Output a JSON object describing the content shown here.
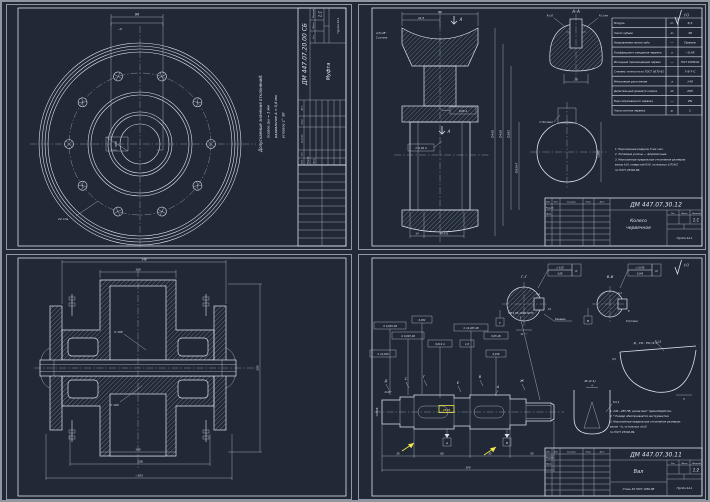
{
  "colors": {
    "background": "#212836",
    "line": "#dde3ea",
    "accent_highlight": "#f4e84c"
  },
  "tb": {
    "r1": "Изм.",
    "r2": "Лист",
    "r3": "№ докум.",
    "r4": "Подп.",
    "r5": "Дата",
    "p1": "Разраб.",
    "p2": "Пров.",
    "p3": "Н.контр.",
    "p4": "Утв.",
    "lit": "Лит.",
    "mass": "Масса",
    "scale_lbl": "Масштаб",
    "org": "Группа 4А-1"
  },
  "sheet1": {
    "title": {
      "doc": "ДМ 447.07.20.00 СБ",
      "name": "Муфта",
      "scale": "1:1"
    },
    "note_title": "Допускаемые значения отклонений:",
    "note_axial": "осевое  Δω = 1 мм",
    "note_radial": "радиальное  Δ ≈ 0,6 мм",
    "note_angular": "угловое  1° 30′",
    "dim_width": "90",
    "dim_key": "~6",
    "dim_holes": "12 отв.",
    "dim_bore": "50H7"
  },
  "sheet2": {
    "roughness": "(√)",
    "section_label": "А–А",
    "sec_r1": "R≈10",
    "sec_r2": "R≈1 мм",
    "sec_w": "28",
    "arrow": "А",
    "dim_top": "90",
    "dim_left": "42,5",
    "chamfer": "4,5×45°",
    "chamfer2": "2 уступа",
    "d1": "∅450",
    "d2": "∅420",
    "d3": "∅265",
    "d4": "∅85H7",
    "b1": "14",
    "b2": "40 h11",
    "tol1": "0,05  А",
    "tol2": "∅ 0,02  А",
    "key_dim": "∅ 64 макс",
    "circle_d": "∅265",
    "table": [
      {
        "name": "Модуль",
        "sym": "m",
        "val": "6,3"
      },
      {
        "name": "Число зубьев",
        "sym": "z₂",
        "val": "48"
      },
      {
        "name": "Направление линии зуба",
        "sym": "—",
        "val": "Правое"
      },
      {
        "name": "Коэффициент смещения червяка",
        "sym": "x",
        "val": "−0,45"
      },
      {
        "name": "Исходный производящий червяк",
        "sym": "—",
        "val": "ГОСТ 19036-94"
      },
      {
        "name": "Степень точности по ГОСТ 3675-81",
        "sym": "",
        "val": "7-8-7-С"
      },
      {
        "name": "Межосевое расстояние",
        "sym": "a",
        "val": "140"
      },
      {
        "name": "Делительный диаметр колеса",
        "sym": "d₂",
        "val": "265"
      },
      {
        "name": "Вид сопряжённого червяка",
        "sym": "—",
        "val": "ZN"
      },
      {
        "name": "Число витков червяка",
        "sym": "z₁",
        "val": "1"
      }
    ],
    "notes": [
      "1. Неуказанные радиусы 5 мм max.",
      "2. Литейные уклоны — формовочные.",
      "3. Неуказанные предельные отклонения размеров:",
      "    валов h14, отверстий H14, остальных ±IT14/2",
      "    по ГОСТ 25346-89."
    ],
    "title": {
      "doc": "ДМ 447.07.30.12",
      "name1": "Колесо",
      "name2": "червячное",
      "scale": "1:1"
    }
  },
  "sheet3": {
    "t1": "148",
    "t2": "100",
    "bore1": "∅ 100",
    "bore2": "∅ 100",
    "b1": "145",
    "b2": "158",
    "b3": "~203",
    "r1": "205"
  },
  "sheet4": {
    "roughness": "(√)",
    "gg_label": "Г–Г",
    "gg_f1": "∅ 0,02",
    "gg_f2": "0,08",
    "gg_flag": "К",
    "gg_datum": "Г",
    "gg_d1": "12",
    "gg_d2": "5,4",
    "gg_d3": "11⁺⁰·²",
    "gg_note": "Канавка",
    "bb_label": "В–В",
    "bb_f1": "∅ 0,018",
    "bb_f2": "0,045",
    "bb_flag": "И",
    "bb_datum": "В",
    "bb_d1": "8",
    "bb_d2": "5,4",
    "bb_d3": "R 0,4 макс",
    "dd_label": "Д , СО : ЕО (4:1)",
    "dd_d1": "R 1,6",
    "dd_d2": "0,5",
    "dd_d3": "5",
    "zh_label": "Ж (4:1)",
    "zh_d1": "4",
    "zh_d2": "R 0,4",
    "thread_note": "ТМ 4 05-19Х0-50ТС",
    "frames": [
      "∅ 0,025 АБ",
      "0,032",
      "∅ 0,025 АБ",
      "0,012 А",
      "∅ 14,025 АБ",
      "1,6",
      "∅ 14,045",
      "0,016",
      "0,05 АБ"
    ],
    "cut1": "Д",
    "cut2": "С",
    "cut3": "Г",
    "cut4": "В",
    "cut5": "А",
    "cut6": "Ж",
    "cut7": "Е",
    "datum_a": "А",
    "datum_b": "Б",
    "sel_dim": "45к6",
    "dim_left": "∅35k6",
    "dim_chamfer": "2×45°",
    "s1": "35",
    "s2": "80",
    "s3": "35",
    "s4": "50",
    "total": "300",
    "notes": [
      "1. 240…285 HB, кроме мест термообработки.",
      "2. * Размер обеспечивается инструментом.",
      "3. Неуказанные предельные отклонения размеров:",
      "    валов −t₂, остальных ±t₂/2",
      "    по ГОСТ 25346-89."
    ],
    "title": {
      "doc": "ДМ 447.07.30.11",
      "name": "Вал",
      "material": "Сталь 45 ГОСТ 1050-88",
      "scale": "1:2"
    }
  }
}
